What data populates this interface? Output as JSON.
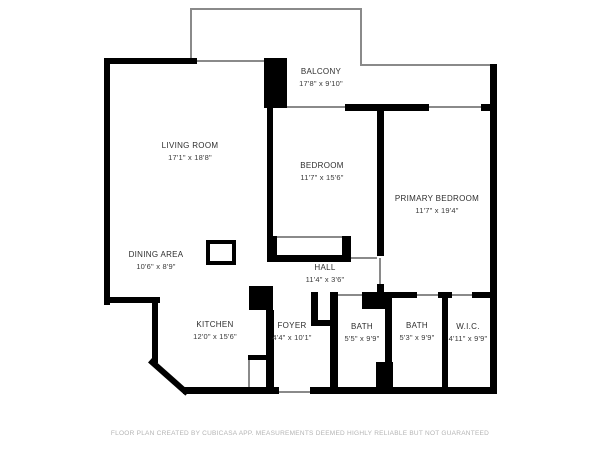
{
  "floorplan": {
    "rooms": [
      {
        "name": "BALCONY",
        "dims": "17'8\" x 9'10\""
      },
      {
        "name": "LIVING ROOM",
        "dims": "17'1\" x 18'8\""
      },
      {
        "name": "BEDROOM",
        "dims": "11'7\" x 15'6\""
      },
      {
        "name": "PRIMARY BEDROOM",
        "dims": "11'7\" x 19'4\""
      },
      {
        "name": "DINING AREA",
        "dims": "10'6\" x 8'9\""
      },
      {
        "name": "HALL",
        "dims": "11'4\" x 3'6\""
      },
      {
        "name": "KITCHEN",
        "dims": "12'0\" x 15'6\""
      },
      {
        "name": "FOYER",
        "dims": "4'4\" x 10'1\""
      },
      {
        "name": "BATH",
        "dims": "5'5\" x 9'9\""
      },
      {
        "name": "BATH",
        "dims": "5'3\" x 9'9\""
      },
      {
        "name": "W.I.C.",
        "dims": "4'11\" x 9'9\""
      }
    ],
    "disclaimer": "FLOOR PLAN CREATED BY CUBICASA APP. MEASUREMENTS DEEMED HIGHLY RELIABLE BUT NOT GUARANTEED",
    "colors": {
      "wall": "#000000",
      "outline": "#8a8a8a",
      "label": "#2e2e2e",
      "disclaimer": "#b4b4b4",
      "background": "#ffffff"
    }
  }
}
